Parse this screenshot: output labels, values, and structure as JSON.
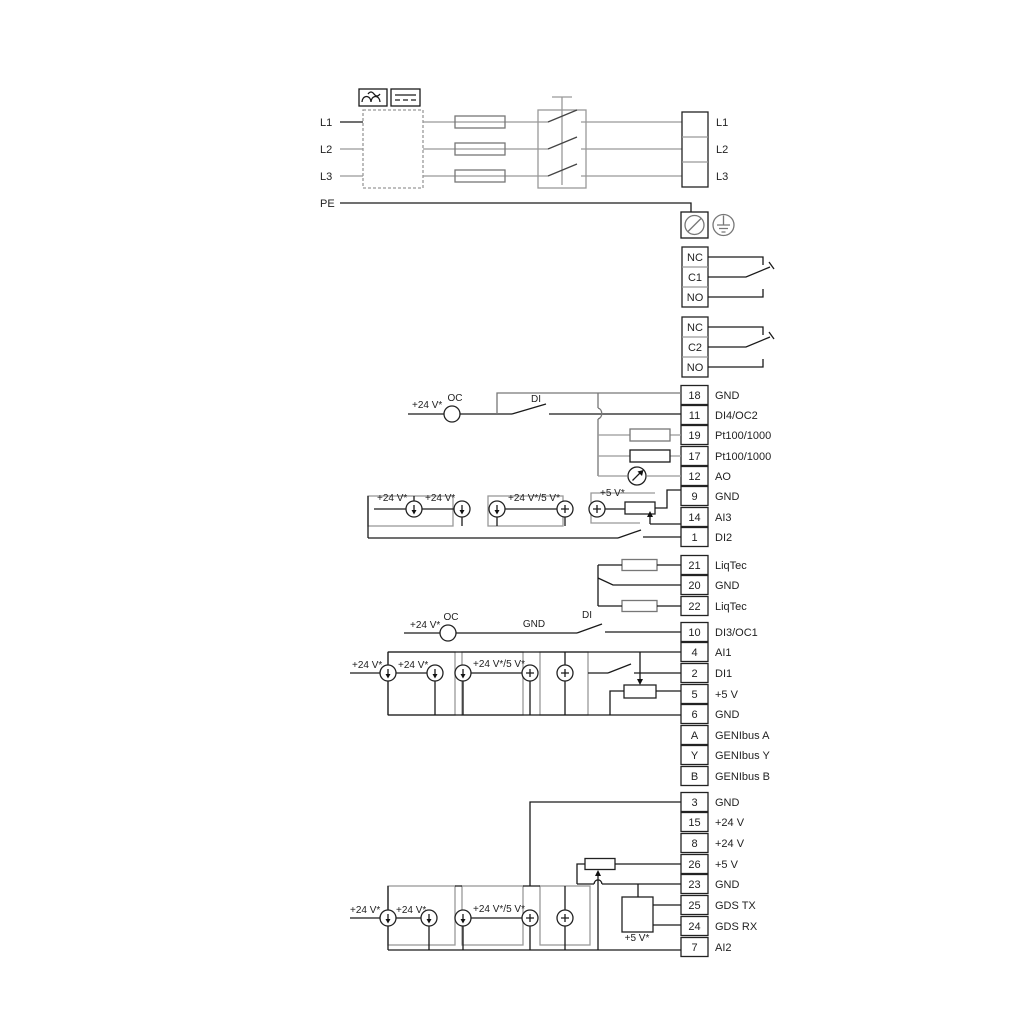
{
  "power": {
    "inputs": [
      "L1",
      "L2",
      "L3",
      "PE"
    ],
    "terminals": [
      "L1",
      "L2",
      "L3"
    ]
  },
  "relay1": [
    "NC",
    "C1",
    "NO"
  ],
  "relay2": [
    "NC",
    "C2",
    "NO"
  ],
  "groupA": [
    {
      "pin": "18",
      "label": "GND"
    },
    {
      "pin": "11",
      "label": "DI4/OC2"
    },
    {
      "pin": "19",
      "label": "Pt100/1000"
    },
    {
      "pin": "17",
      "label": "Pt100/1000"
    },
    {
      "pin": "12",
      "label": "AO"
    },
    {
      "pin": "9",
      "label": "GND"
    },
    {
      "pin": "14",
      "label": "AI3"
    },
    {
      "pin": "1",
      "label": "DI2"
    }
  ],
  "groupB": [
    {
      "pin": "21",
      "label": "LiqTec"
    },
    {
      "pin": "20",
      "label": "GND"
    },
    {
      "pin": "22",
      "label": "LiqTec"
    }
  ],
  "groupC": [
    {
      "pin": "10",
      "label": "DI3/OC1"
    },
    {
      "pin": "4",
      "label": "AI1"
    },
    {
      "pin": "2",
      "label": "DI1"
    },
    {
      "pin": "5",
      "label": "+5 V"
    },
    {
      "pin": "6",
      "label": "GND"
    },
    {
      "pin": "A",
      "label": "GENIbus A"
    },
    {
      "pin": "Y",
      "label": "GENIbus Y"
    },
    {
      "pin": "B",
      "label": "GENIbus B"
    }
  ],
  "groupD": [
    {
      "pin": "3",
      "label": "GND"
    },
    {
      "pin": "15",
      "label": "+24 V"
    },
    {
      "pin": "8",
      "label": "+24 V"
    },
    {
      "pin": "26",
      "label": "+5 V"
    },
    {
      "pin": "23",
      "label": "GND"
    },
    {
      "pin": "25",
      "label": "GDS TX"
    },
    {
      "pin": "24",
      "label": "GDS RX"
    },
    {
      "pin": "7",
      "label": "AI2"
    }
  ],
  "ann": {
    "v24": "+24 V*",
    "v24_5": "+24 V*/5 V*",
    "v5": "+5 V*",
    "oc": "OC",
    "di": "DI",
    "gnd": "GND"
  },
  "colors": {
    "wire": "#1a1a1a",
    "wire_grey": "#999999",
    "frame_grey": "#9a9a9a"
  }
}
